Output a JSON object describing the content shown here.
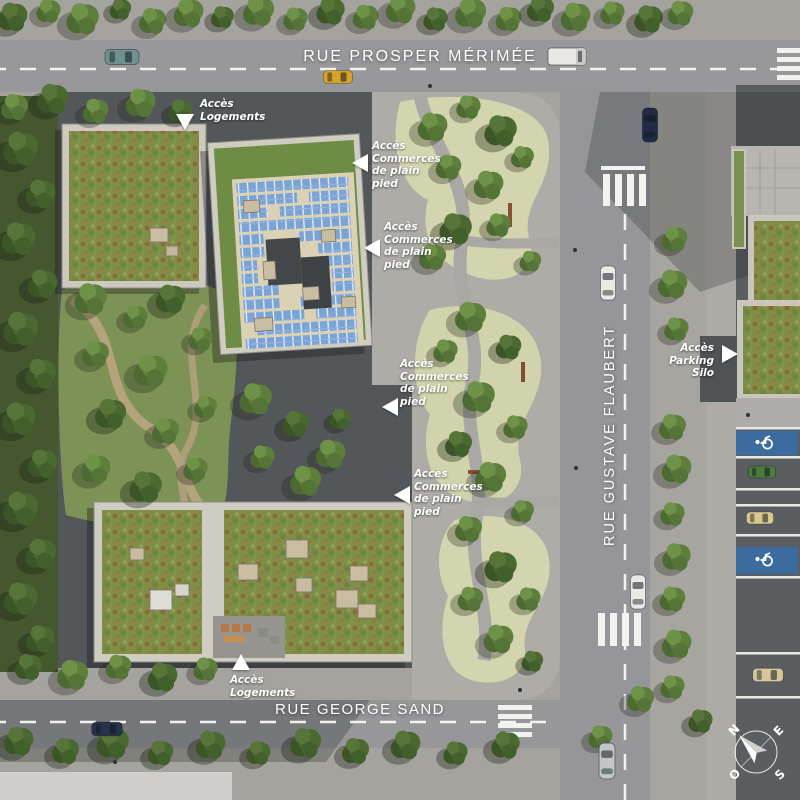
{
  "streets": {
    "top": "RUE PROSPER MÉRIMÉE",
    "right": "RUE GUSTAVE FLAUBERT",
    "bottom": "RUE GEORGE SAND"
  },
  "annotations": {
    "logements_nw": {
      "line1": "Accès",
      "line2": "Logements"
    },
    "commerces_1": {
      "line1": "Accès",
      "line2": "Commerces",
      "line3": "de plain",
      "line4": "pied"
    },
    "commerces_2": {
      "line1": "Accès",
      "line2": "Commerces",
      "line3": "de plain",
      "line4": "pied"
    },
    "commerces_3": {
      "line1": "Accès",
      "line2": "Commerces",
      "line3": "de plain",
      "line4": "pied"
    },
    "commerces_4": {
      "line1": "Accès",
      "line2": "Commerces",
      "line3": "de plain",
      "line4": "pied"
    },
    "parking_silo": {
      "line1": "Accès",
      "line2": "Parking Silo"
    },
    "logements_s": {
      "line1": "Accès",
      "line2": "Logements"
    }
  },
  "compass": {
    "north": "N",
    "east": "E",
    "south": "S",
    "west": "O"
  },
  "icons": {
    "disabled_parking": "wheelchair-icon",
    "compass_rose": "compass-rose-icon",
    "access_arrows": "arrow-icon"
  },
  "colors": {
    "road": "#98989b",
    "plaza": "#aeaca6",
    "gravel": "#d2d5ad",
    "parcel_ground": "#54575a",
    "forest": "#44572e",
    "park_grass": "#7d9355",
    "green_roof": "#6f8c45",
    "sedum_red": "#9b5a35",
    "solar_panel": "#7aa3d6",
    "walkway_beige": "#dbd2b5",
    "disabled_bay_blue": "#3c6ba0",
    "road_marking": "#f2f2ef",
    "label_text": "#ffffff"
  }
}
